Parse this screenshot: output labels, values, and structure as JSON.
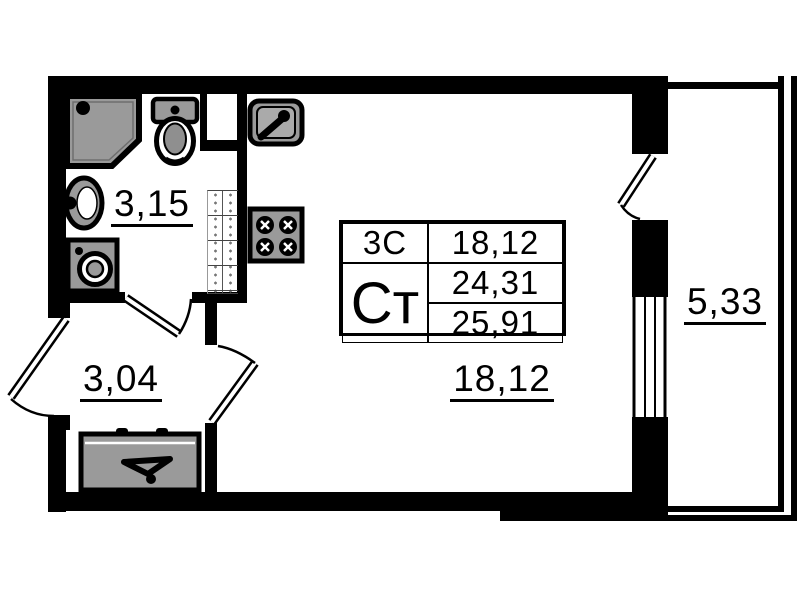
{
  "labels": {
    "bathroom_area": "3,15",
    "hallway_area": "3,04",
    "living_area": "18,12",
    "balcony_area": "5,33"
  },
  "unit_table": {
    "rooms_label": "3С",
    "rooms_value": "18,12",
    "type_label": "Ст",
    "living_value": "24,31",
    "total_value": "25,91"
  },
  "icons": [
    "shower-icon",
    "toilet-icon",
    "washbasin-icon",
    "washing-machine-icon",
    "kitchen-sink-icon",
    "stove-icon",
    "wardrobe-icon",
    "door-swing-icon",
    "window-icon",
    "shaft-hatch-icon"
  ],
  "colors": {
    "wall": "#000000",
    "fixture_fill": "#9a9a9a",
    "background": "#ffffff"
  }
}
